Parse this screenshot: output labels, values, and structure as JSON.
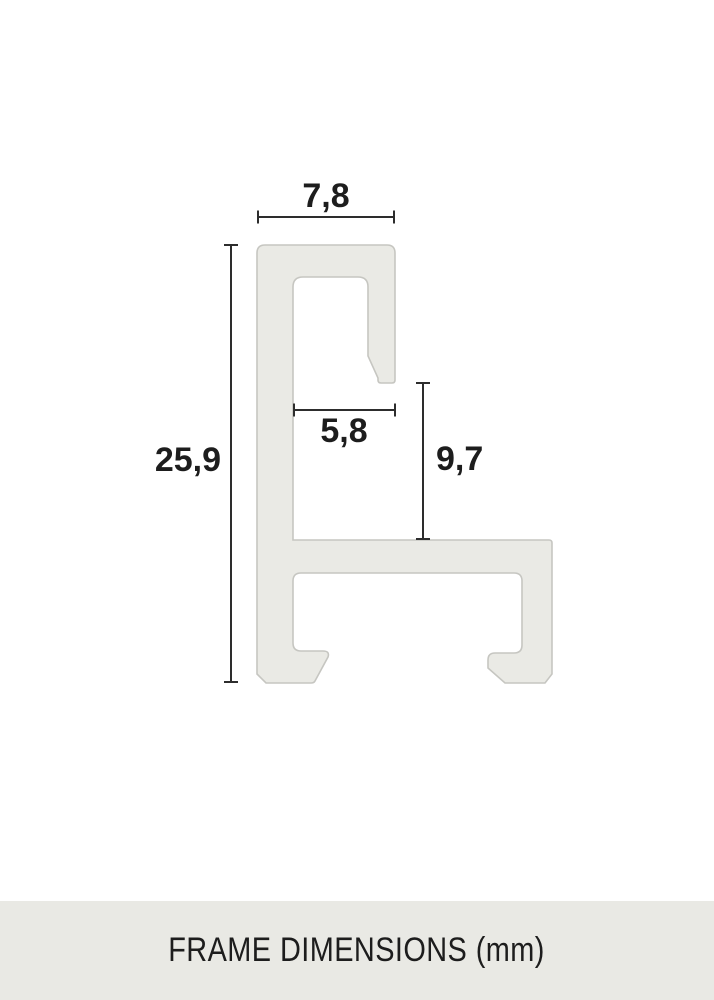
{
  "diagram": {
    "subject": "aluminium picture frame profile cross-section",
    "dimensions": [
      {
        "id": "outer-top-width",
        "value": "7,8",
        "orientation": "horizontal"
      },
      {
        "id": "overall-height",
        "value": "25,9",
        "orientation": "vertical"
      },
      {
        "id": "inner-top-width",
        "value": "5,8",
        "orientation": "horizontal"
      },
      {
        "id": "rabbet-height",
        "value": "9,7",
        "orientation": "vertical"
      }
    ],
    "colors": {
      "profile_fill": "#eaeae5",
      "profile_stroke": "#c6c6c1",
      "dimension_line": "#2d2d2d",
      "label_text": "#1d1d1d"
    }
  },
  "footer": {
    "label": "FRAME DIMENSIONS (mm)",
    "background": "#e9e9e4",
    "text_color": "#1d1d1d"
  }
}
